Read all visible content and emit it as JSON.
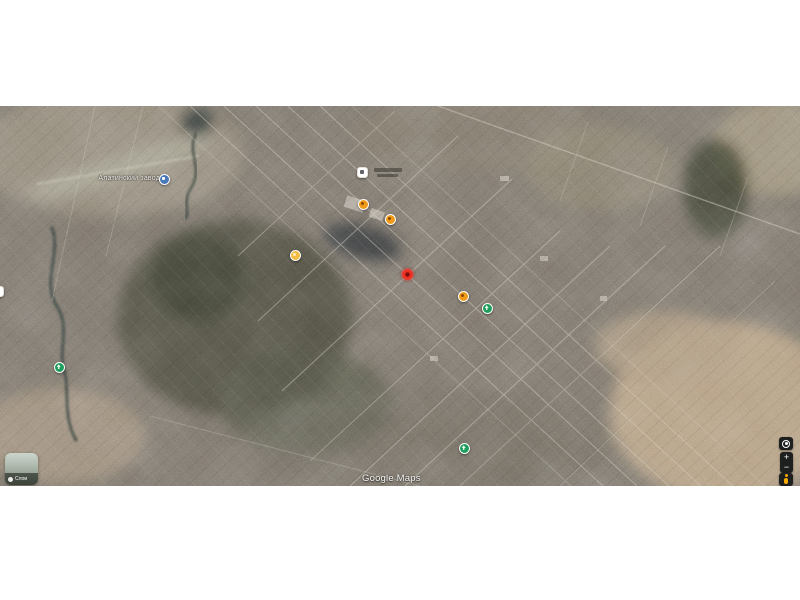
{
  "canvas": {
    "background": "#ffffff"
  },
  "map": {
    "attribution": "Google Maps",
    "place_label": "Алатинский завод",
    "layers_button": {
      "label": "Слои"
    },
    "controls": {
      "zoom_in": "+",
      "zoom_out": "−"
    },
    "markers": [
      {
        "name": "poi-factory-icon",
        "type": "poi-white",
        "x": 362,
        "y": 66
      },
      {
        "name": "poi-white-clipped",
        "type": "poi-white",
        "x": -2,
        "y": 185
      },
      {
        "name": "poi-blue-marker",
        "type": "blue",
        "x": 164,
        "y": 73
      },
      {
        "name": "poi-orange-marker-1",
        "type": "orange",
        "x": 363,
        "y": 98
      },
      {
        "name": "poi-orange-marker-2",
        "type": "orange",
        "x": 390,
        "y": 113
      },
      {
        "name": "poi-amber-marker",
        "type": "amber",
        "x": 295,
        "y": 149
      },
      {
        "name": "selected-location-dot",
        "type": "red-dot",
        "x": 407,
        "y": 168
      },
      {
        "name": "poi-orange-marker-3",
        "type": "orange",
        "x": 463,
        "y": 190
      },
      {
        "name": "poi-green-marker-1",
        "type": "green",
        "x": 487,
        "y": 202
      },
      {
        "name": "poi-green-marker-2",
        "type": "green",
        "x": 59,
        "y": 261
      },
      {
        "name": "poi-green-marker-3",
        "type": "green",
        "x": 464,
        "y": 342
      }
    ],
    "colors": {
      "marker_orange": "#F09A1A",
      "marker_amber": "#F2BB41",
      "marker_green": "#1E9E5C",
      "marker_blue": "#4878B8",
      "marker_red": "#EE3124",
      "pegman": "#F9AB00",
      "control_background": "#1E1F1F",
      "terrain_base": "#7B746B",
      "field_light": "#B59F82",
      "forest_dark": "#4C4E40"
    }
  }
}
